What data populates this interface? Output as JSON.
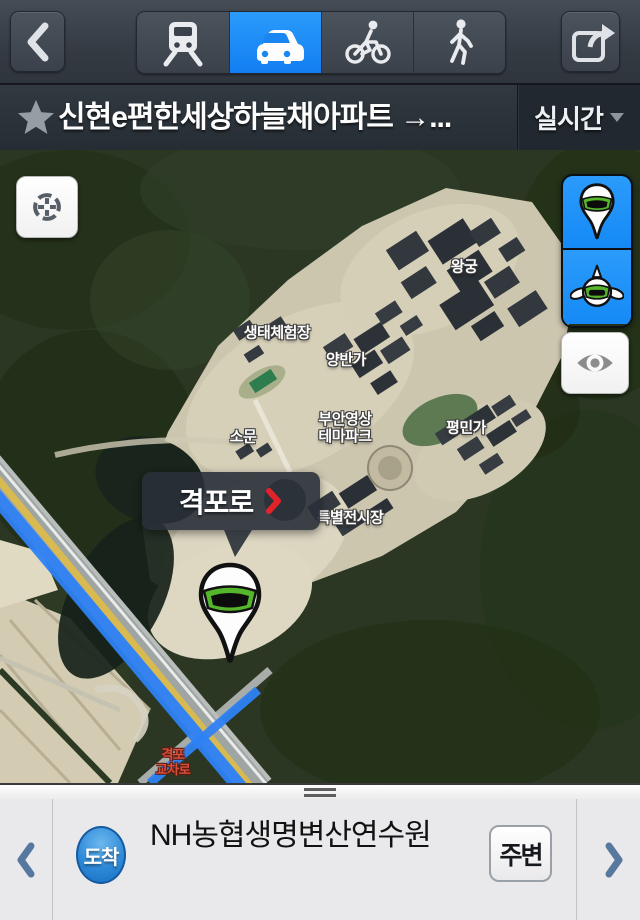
{
  "header": {
    "back_icon": "chevron-left",
    "mode_icons": {
      "transit": "train",
      "car": "car",
      "bicycle": "bicycle",
      "walk": "pedestrian"
    },
    "selected_mode": "car",
    "share_icon": "share-export",
    "selected_color": "#1e8cf5"
  },
  "route_bar": {
    "favorite_icon": "star",
    "title": "신현e편한세상하늘채아파트 →...",
    "realtime_label": "실시간",
    "dropdown_icon": "caret-down"
  },
  "map": {
    "type": "satellite",
    "labels": [
      {
        "text": "왕궁"
      },
      {
        "text": "생태체험장"
      },
      {
        "text": "양반가"
      },
      {
        "text": "소문"
      },
      {
        "text": "부안영상\n테마파크"
      },
      {
        "text": "평민가"
      },
      {
        "text": "특별전시장"
      },
      {
        "text": "격포\n교차로"
      }
    ],
    "tooltip": {
      "text": "격포로",
      "chevron_icon": "chevron-right-red"
    },
    "controls": {
      "locate_icon": "crosshair-target",
      "marker_button_icon": "roadview-pin",
      "roadview_button_icon": "roadview-flying-pin",
      "visibility_button_icon": "eye"
    },
    "colors": {
      "route_blue": "#2f82f5",
      "road_yellow": "#d9ba50",
      "pin_green": "#55b62c"
    }
  },
  "bottom_bar": {
    "prev_icon": "chevron-left",
    "badge_label": "도착",
    "title": "NH농협생명변산연수원",
    "around_label": "주변",
    "next_icon": "chevron-right"
  }
}
